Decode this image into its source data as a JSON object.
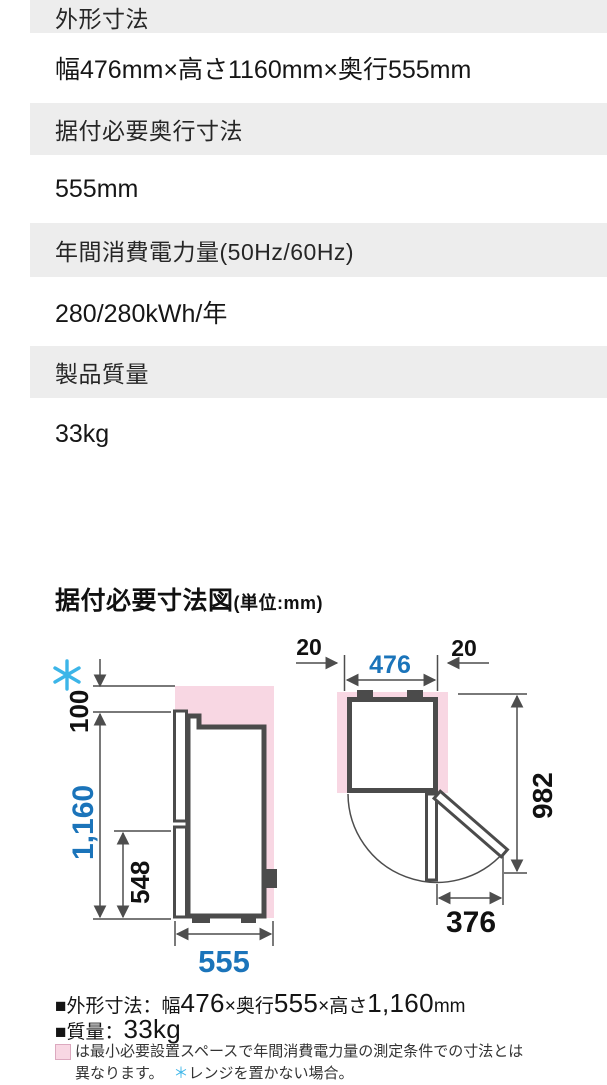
{
  "colors": {
    "accent_blue": "#1b74ba",
    "accent_cyan": "#3cb5e8",
    "pink_fill": "#f8d7e3",
    "outline_dark": "#4b4b4b",
    "header_bg": "#ededed"
  },
  "spec_table": {
    "rows": [
      {
        "label": "外形寸法",
        "value": "幅476mm×高さ1160mm×奥行555mm"
      },
      {
        "label": "据付必要奥行寸法",
        "value": "555mm"
      },
      {
        "label": "年間消費電力量(50Hz/60Hz)",
        "value": "280/280kWh/年"
      },
      {
        "label": "製品質量",
        "value": "33kg"
      }
    ]
  },
  "diagram": {
    "title": "据付必要寸法図",
    "unit": "(単位:mm)",
    "side_view": {
      "top_clearance": "100",
      "height": "1,160",
      "lower_height": "548",
      "depth": "555"
    },
    "top_view": {
      "gap_left": "20",
      "width": "476",
      "gap_right": "20",
      "total_depth": "982",
      "door_width": "376"
    }
  },
  "footer": {
    "line1": {
      "a": "■外形寸法：幅",
      "b": "476",
      "c": "×奥行",
      "d": "555",
      "e": "×高さ",
      "f": "1,160",
      "g": "mm"
    },
    "line2": {
      "a": "■質量：",
      "b": "33kg"
    },
    "note": {
      "line1": "は最小必要設置スペースで年間消費電力量の測定条件での寸法とは",
      "line2a": "異なります。",
      "star": "＊",
      "line2b": "レンジを置かない場合。"
    }
  }
}
